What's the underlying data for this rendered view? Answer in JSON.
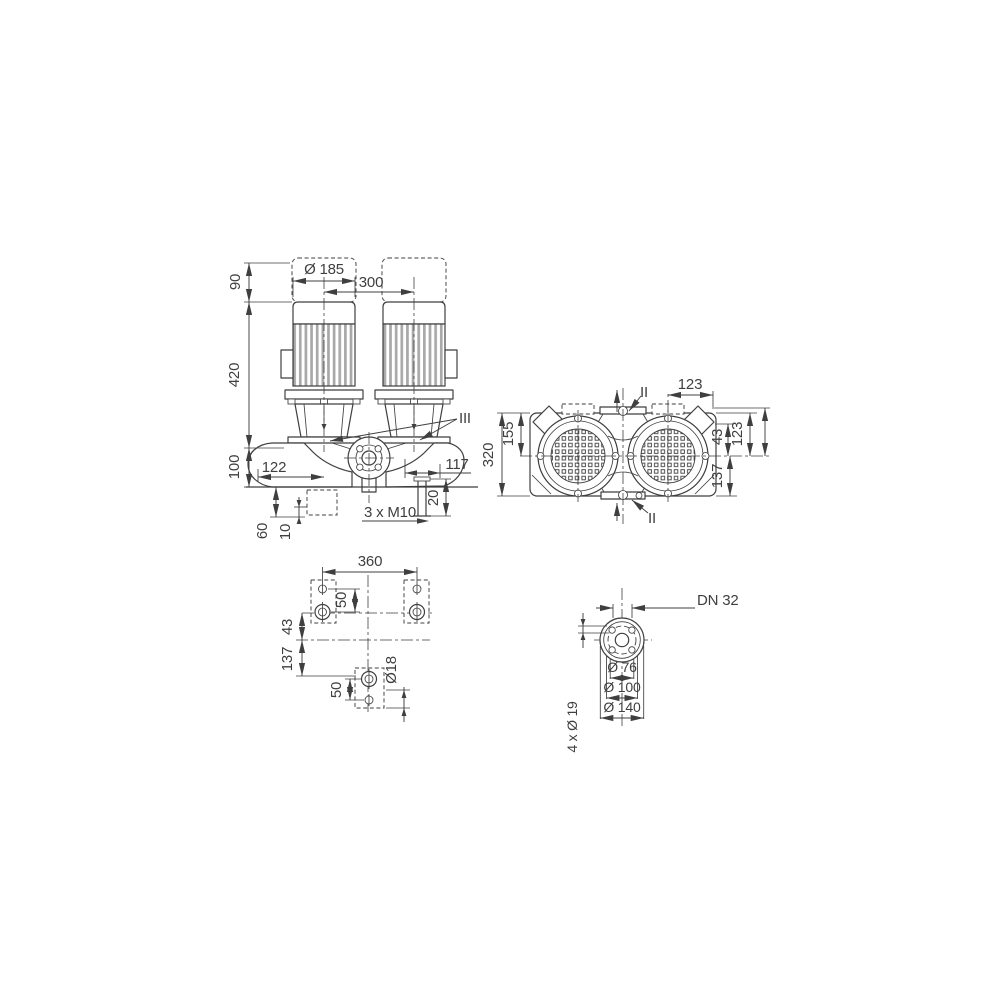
{
  "drawing": {
    "colors": {
      "ink": "#3f3f3f",
      "fin_fill": "#a9a9a9",
      "background": "#ffffff"
    },
    "front_view": {
      "dim_90": "90",
      "dim_420": "420",
      "dim_100": "100",
      "dim_dia_185": "Ø 185",
      "dim_300": "300",
      "dim_122": "122",
      "dim_117": "117",
      "dim_20": "20",
      "label_3xM10": "3 x M10",
      "dim_60": "60",
      "dim_10": "10",
      "label_III": "III"
    },
    "top_view": {
      "dim_320": "320",
      "dim_155": "155",
      "dim_123_top": "123",
      "dim_43": "43",
      "dim_123_right": "123",
      "dim_137": "137",
      "label_II_top": "II",
      "label_II_bottom": "II"
    },
    "plan_view": {
      "dim_360": "360",
      "dim_50_upper": "50",
      "dim_43": "43",
      "dim_137": "137",
      "dim_50_lower": "50",
      "dim_dia_18": "Ø18"
    },
    "flange_view": {
      "label_DN": "DN 32",
      "dim_dia_76": "Ø 76",
      "dim_dia_100": "Ø 100",
      "dim_dia_140": "Ø 140",
      "dim_4x_dia_19": "4 x Ø 19"
    }
  }
}
